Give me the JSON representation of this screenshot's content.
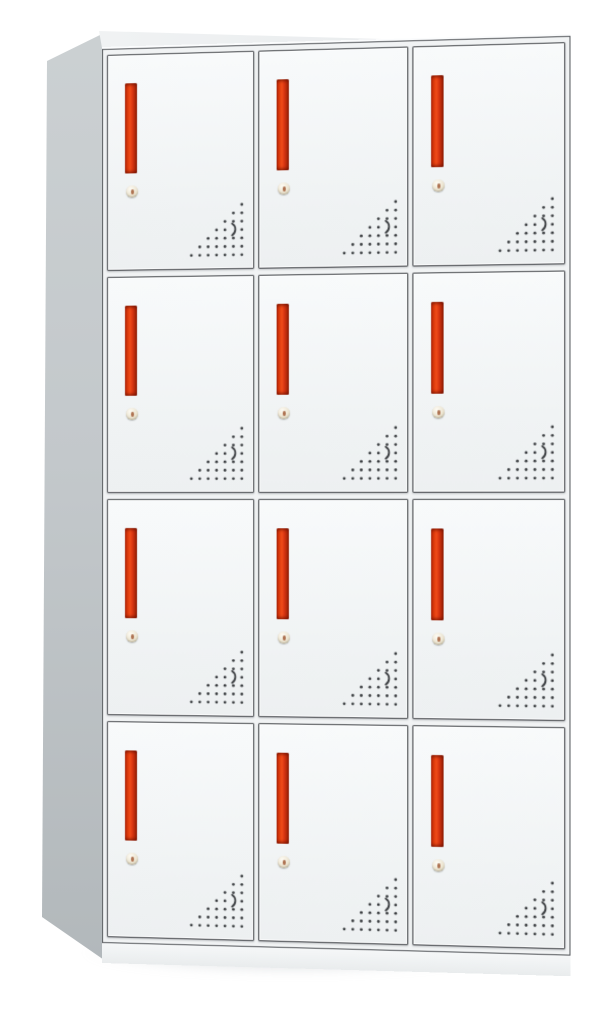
{
  "scene": {
    "type": "product-photo",
    "subject": "12-compartment steel locker cabinet, 4 rows x 3 columns, white doors with red vertical handles",
    "background_color": "#ffffff"
  },
  "locker": {
    "grid": {
      "rows": 4,
      "columns": 3,
      "door_count": 12
    },
    "colors": {
      "door_face": "#f3f5f6",
      "door_border": "#474a4e",
      "frame_fill": "#f1f3f4",
      "front_fill": "#fbfcfd",
      "side_panel_light": "#ccd1d3",
      "side_panel_dark": "#b0b6b9",
      "top_face_light": "#f2f4f5",
      "top_face_dark": "#e4e7e9",
      "handle_bright": "#f04c19",
      "handle_mid": "#d93611",
      "handle_dark": "#921d04",
      "lock_body": "#ece5d2",
      "lock_keyhole": "#a05a36",
      "vent_dot": "#3c3f42",
      "floor_shadow": "#b0b6bb"
    },
    "door_features": {
      "handle": "recessed vertical red grip",
      "lock": "round keyed cam lock",
      "vents": "triangular perforated dot pattern with curved crescent slot"
    },
    "vent_pattern": {
      "rows": 7,
      "columns": 7,
      "spacing": 8.3,
      "dot_radius": 1.4,
      "alignment": "right-triangle, right angle at bottom-right",
      "crescent": {
        "row": 3,
        "col": 5,
        "path": "M43.2 21.8 C47.6 24.6 47.4 30.6 43.2 33.6"
      }
    }
  }
}
